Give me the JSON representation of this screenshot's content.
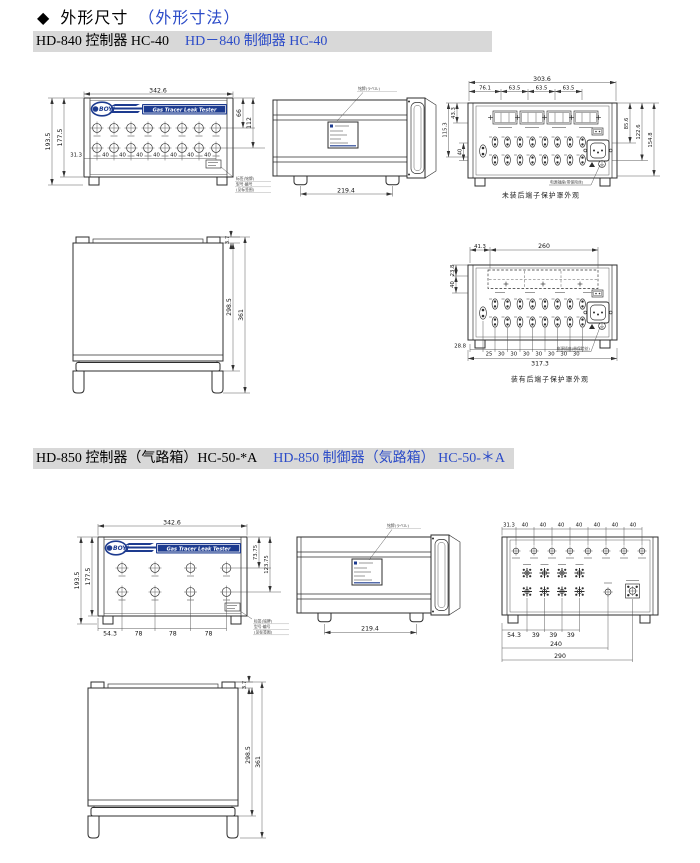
{
  "heading": {
    "bullet": "◆",
    "title_zh": "外形尺寸",
    "title_jp": "（外形寸法）"
  },
  "brand": {
    "name": "BOYI",
    "tagline": "Gas Tracer Leak Tester"
  },
  "colors": {
    "accent_blue": "#2B4BC8",
    "band_gray": "#D8D8D8",
    "logo_navy": "#1D3B8F",
    "line": "#2D2D2D"
  },
  "hd840": {
    "title_zh": "HD-840 控制器 HC-40",
    "title_jp": "HD－840 制御器 HC-40",
    "front": {
      "width": "342.6",
      "height_outer": "193.5",
      "height_inner": "177.5",
      "right_row1": "66",
      "right_row2": "112",
      "left_offset": "31.3",
      "pitch": "40"
    },
    "side": {
      "depth": "219.4"
    },
    "rear": {
      "width": "303.6",
      "seg1": "76.1",
      "seg2": "63.5",
      "left_outer": "115.3",
      "left_top": "43.3",
      "left_mid": "40",
      "right1": "85.6",
      "right2": "122.6",
      "right3": "154.8",
      "caption": "未装后端子保护罩外观"
    },
    "top": {
      "lip": "3.7",
      "inner": "298.5",
      "outer": "361"
    },
    "rear_cover": {
      "t1": "41.3",
      "t2": "260",
      "left1": "23.8",
      "left2": "40",
      "bottom_left": "28.8",
      "b1": "25",
      "pitch": "30",
      "total": "317.3",
      "caption": "装有后端子保护罩外观"
    }
  },
  "hd850": {
    "title_zh": "HD-850 控制器（气路箱）HC-50-*A",
    "title_jp": "HD-850 制御器（気路箱） HC-50-＊A",
    "front": {
      "width": "342.6",
      "height_outer": "193.5",
      "height_inner": "177.5",
      "right_row1": "73.75",
      "right_row2": "123.75",
      "left_offset": "54.3",
      "pitch": "78"
    },
    "side": {
      "depth": "219.4"
    },
    "rear": {
      "t1": "31.3",
      "pitch_top": "40",
      "b1": "54.3",
      "pitch_bottom": "39",
      "width_power": "240",
      "width_inlet": "290"
    },
    "top": {
      "lip": "3.7",
      "inner": "298.5",
      "outer": "361"
    }
  },
  "notes": {
    "nameplate": "铭牌(ラベル)",
    "label_lines": [
      "标签(铭牌)",
      "型号·编号",
      "(见标签图)"
    ],
    "power_note": "电源插座(带保险丝)"
  }
}
